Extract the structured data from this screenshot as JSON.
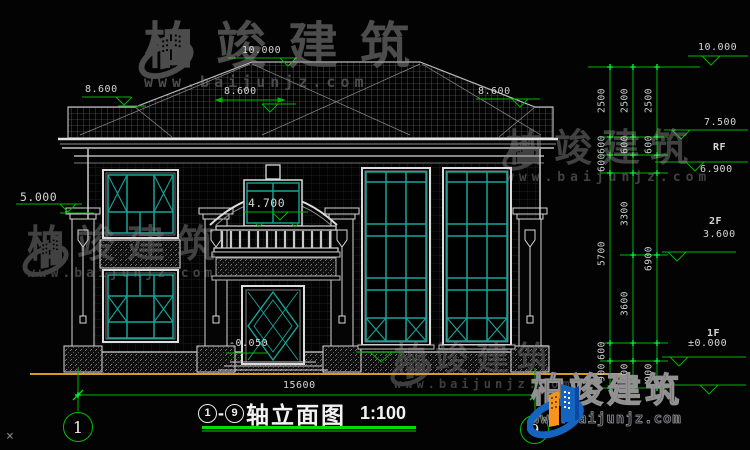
{
  "watermarks": {
    "brand": "柏竣建筑",
    "website": "www.baijunjz.com"
  },
  "title_block": {
    "axis_from": "1",
    "dash": "-",
    "axis_to": "9",
    "name": "轴立面图",
    "scale": "1:100"
  },
  "axis_bubbles": {
    "left": "1",
    "right": "9"
  },
  "elevations": {
    "ridge": "10.000",
    "eave_left": "8.600",
    "eave_mid": "8.600",
    "eave_right": "8.600",
    "porch": "5.000",
    "balcony": "4.700",
    "entry": "-0.050"
  },
  "overall": {
    "width": "15600"
  },
  "right_dims": {
    "levels": [
      {
        "elev": "10.000",
        "floor": ""
      },
      {
        "elev": "7.500",
        "floor": "RF"
      },
      {
        "elev": "6.900",
        "floor": ""
      },
      {
        "elev": "3.600",
        "floor": "2F"
      },
      {
        "elev": "±0.000",
        "floor": "1F"
      }
    ],
    "col_a": [
      "2500",
      "600",
      "600",
      "5700",
      "600",
      "900"
    ],
    "col_b": [
      "2500",
      "600",
      "3300",
      "3600",
      "900"
    ],
    "col_c": [
      "2500",
      "600",
      "6900",
      "900"
    ]
  },
  "misc": {
    "corner_mark": "×"
  },
  "colors": {
    "dim_green": "#00b400",
    "tick_green": "#00ff44",
    "window_teal": "#16a59a",
    "ground_yellow": "#d4a017",
    "logo_blue": "#1565c0",
    "logo_orange": "#f7941d"
  }
}
